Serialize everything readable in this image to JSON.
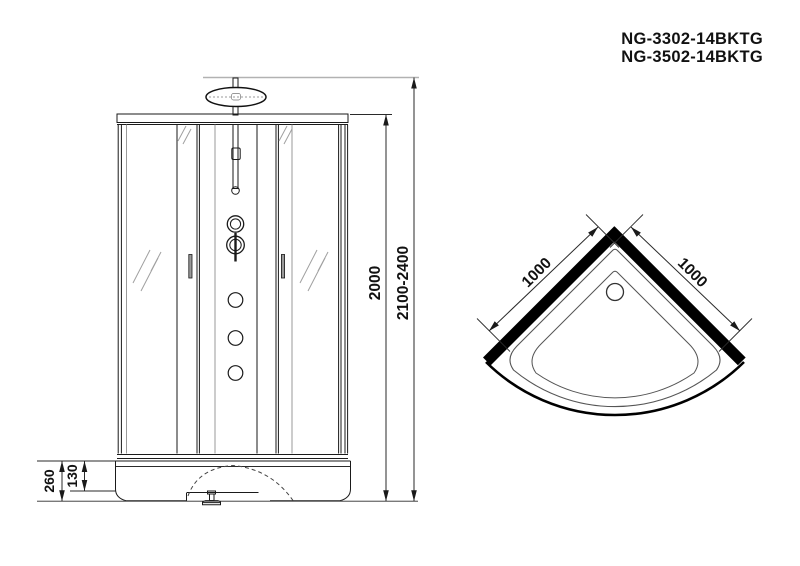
{
  "product_codes": {
    "line1": "NG-3302-14BKTG",
    "line2": "NG-3502-14BKTG"
  },
  "front_view": {
    "cabin_height_mm": "2000",
    "total_height_range_mm": "2100-2400",
    "base_height_mm": "260",
    "base_inner_height_mm": "130"
  },
  "top_view": {
    "left_side_mm": "1000",
    "right_side_mm": "1000"
  },
  "colors": {
    "background": "#ffffff",
    "line": "#1a1a1a",
    "wall_fill": "#000000",
    "glass_hint": "#a0a0a0",
    "extension_gray": "#b2b2b2"
  }
}
